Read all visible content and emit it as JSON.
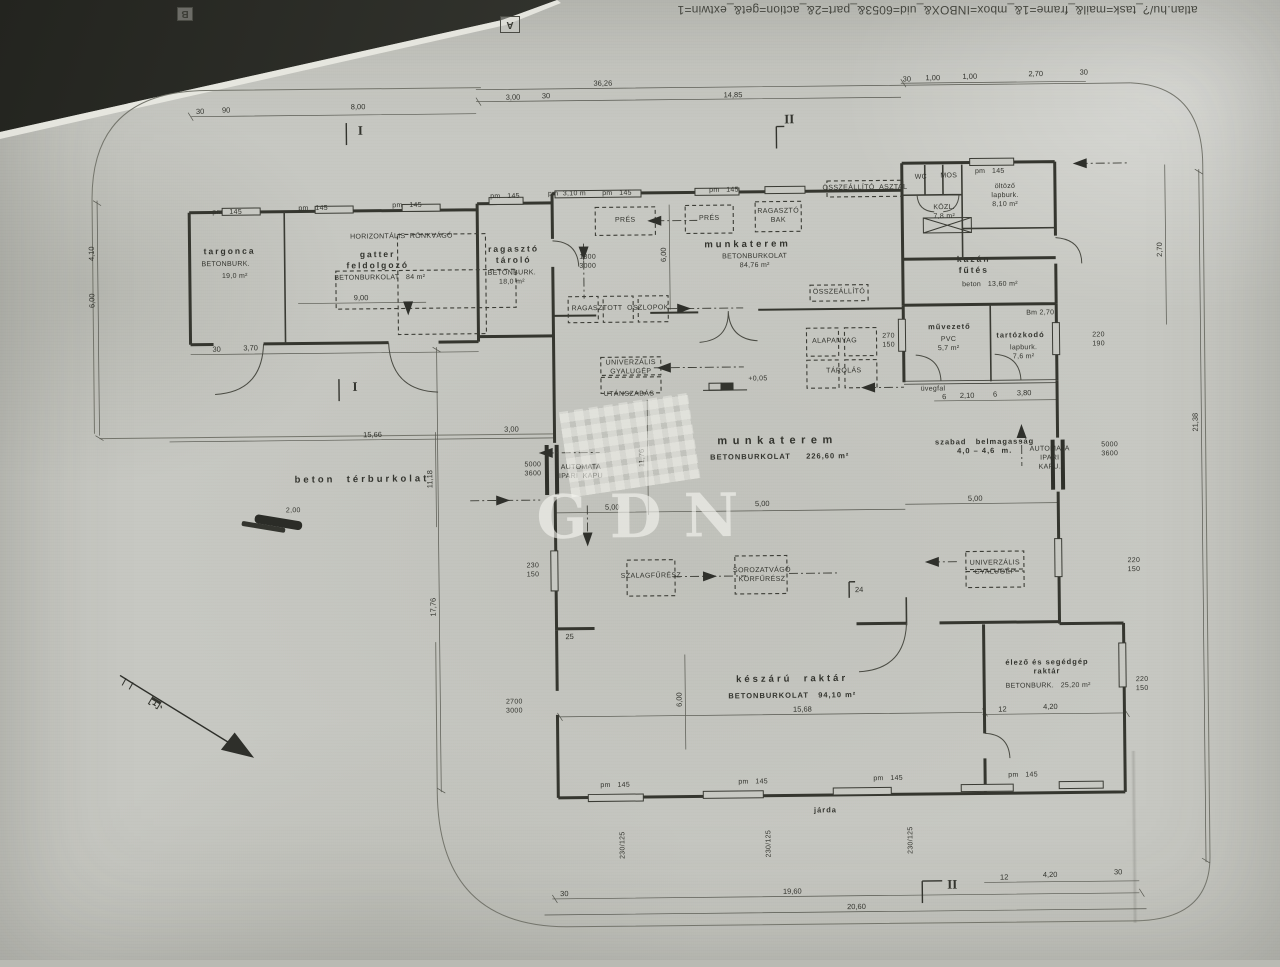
{
  "header": {
    "url": "atlan.hu/?_task=mail&_frame=1&_mbox=INBOX&_uid=6053&_part=2&_action=get&_extwin=1",
    "marker_a": "A",
    "marker_b": "B"
  },
  "watermark": {
    "text": "GDN"
  },
  "plan": {
    "labels": [
      {
        "n": "room-targonca",
        "t": "targonca",
        "x": 232,
        "y": 247,
        "c": "rm-s"
      },
      {
        "n": "finish-targonca",
        "t": "BETONBURK.",
        "x": 228,
        "y": 261,
        "c": "tny"
      },
      {
        "n": "area-targonca",
        "t": "19,0 m²",
        "x": 237,
        "y": 273,
        "c": "tny"
      },
      {
        "n": "room-gatter-feldolgozo",
        "t": "gatter\nfeldolgozó",
        "x": 380,
        "y": 257,
        "c": "rm-s"
      },
      {
        "n": "finish-gatter",
        "t": "BETONBURKOLAT   84 m²",
        "x": 382,
        "y": 276,
        "c": "tny"
      },
      {
        "n": "machine-horizontalis-ronkvago",
        "t": "HORIZONTÁLIS  RÖNKVÁGÓ",
        "x": 404,
        "y": 235,
        "c": "tny"
      },
      {
        "n": "room-ragaszto-tarolo",
        "t": "ragasztó\ntároló",
        "x": 516,
        "y": 253,
        "c": "rm-s"
      },
      {
        "n": "finish-ragaszto-tarolo",
        "t": "BETONBURK.\n18,0 m²",
        "x": 514,
        "y": 277,
        "c": "tny"
      },
      {
        "n": "room-munkaterem-1",
        "t": "munkaterem",
        "x": 750,
        "y": 246,
        "c": "rm"
      },
      {
        "n": "finish-munkaterem-1",
        "t": "BETONBURKOLAT\n84,76 m²",
        "x": 757,
        "y": 263,
        "c": "tny"
      },
      {
        "n": "machine-pres-1",
        "t": "PRÉS",
        "x": 628,
        "y": 221,
        "c": "mach"
      },
      {
        "n": "machine-pres-2",
        "t": "PRÉS",
        "x": 712,
        "y": 220,
        "c": "mach"
      },
      {
        "n": "machine-ragaszto-bak",
        "t": "RAGASZTÓ\nBAK",
        "x": 781,
        "y": 218,
        "c": "mach"
      },
      {
        "n": "machine-osszeallito-asztal",
        "t": "ÖSSZEÁLLÍTÓ  ASZTAL",
        "x": 868,
        "y": 191,
        "c": "mach"
      },
      {
        "n": "room-wc",
        "t": "WC",
        "x": 924,
        "y": 181,
        "c": "tny"
      },
      {
        "n": "room-mos",
        "t": "MOS",
        "x": 952,
        "y": 180,
        "c": "tny"
      },
      {
        "n": "room-oltozo",
        "t": "öltöző\nlapburk.\n8,10 m²",
        "x": 1008,
        "y": 200,
        "c": "tny"
      },
      {
        "n": "room-kozl",
        "t": "KÖZL.\n7,8 m²",
        "x": 947,
        "y": 216,
        "c": "tny"
      },
      {
        "n": "room-kazan-futes",
        "t": "kazán\nfűtés",
        "x": 976,
        "y": 268,
        "c": "rm-s"
      },
      {
        "n": "finish-kazan",
        "t": "beton   13,60 m²",
        "x": 992,
        "y": 289,
        "c": "tny"
      },
      {
        "n": "machine-osszeallito-2",
        "t": "ÖSSZEÁLLÍTÓ",
        "x": 841,
        "y": 295,
        "c": "mach"
      },
      {
        "n": "machine-alapanyag",
        "t": "ALAPANYAG",
        "x": 836,
        "y": 344,
        "c": "mach"
      },
      {
        "n": "machine-tarolas",
        "t": "TÁROLÁS",
        "x": 845,
        "y": 374,
        "c": "mach"
      },
      {
        "n": "machine-ragasztott-oszlopok",
        "t": "RAGASZTOTT  OSZLOPOK",
        "x": 622,
        "y": 309,
        "c": "mach"
      },
      {
        "n": "door-dim-1300-3000",
        "t": "1300\n3000",
        "x": 590,
        "y": 262,
        "c": "tny"
      },
      {
        "n": "room-muvezeto",
        "t": "művezető",
        "x": 951,
        "y": 330,
        "c": "sub"
      },
      {
        "n": "finish-muvezeto",
        "t": "PVC\n5,7 m²",
        "x": 950,
        "y": 348,
        "c": "tny"
      },
      {
        "n": "room-tartozkodo",
        "t": "tartózkodó",
        "x": 1022,
        "y": 339,
        "c": "sub"
      },
      {
        "n": "finish-tartozkodo",
        "t": "lapburk.\n7,6 m²",
        "x": 1025,
        "y": 357,
        "c": "tny"
      },
      {
        "n": "note-bm-270",
        "t": "Bm 2,70",
        "x": 1042,
        "y": 318,
        "c": "tny"
      },
      {
        "n": "note-uvegfal",
        "t": "üvegfal",
        "x": 934,
        "y": 393,
        "c": "tny"
      },
      {
        "n": "machine-univerzalis-gyalugep-1",
        "t": "UNIVERZÁLIS\nGYALUGÉP",
        "x": 632,
        "y": 368,
        "c": "mach"
      },
      {
        "n": "note-utanszabas",
        "t": "UTÁNSZABÁS",
        "x": 630,
        "y": 395,
        "c": "mach"
      },
      {
        "n": "note-level-mark",
        "t": "+0,05",
        "x": 759,
        "y": 381,
        "c": "tny"
      },
      {
        "n": "room-munkaterem-2",
        "t": "munkaterem",
        "x": 778,
        "y": 443,
        "c": "rml"
      },
      {
        "n": "finish-munkaterem-2",
        "t": "BETONBURKOLAT     226,60 m²",
        "x": 780,
        "y": 458,
        "c": "sub"
      },
      {
        "n": "note-szabad-belmagassag",
        "t": "szabad   belmagasság\n4,0 – 4,6  m.",
        "x": 985,
        "y": 450,
        "c": "sub"
      },
      {
        "n": "label-automata-kapu-right",
        "t": "AUTOMATA\nIPARI\nKAPU.",
        "x": 1050,
        "y": 463,
        "c": "tny"
      },
      {
        "n": "dim-kapu-right",
        "t": "5000\n3600",
        "x": 1110,
        "y": 455,
        "c": "tny"
      },
      {
        "n": "label-automata-kapu-left",
        "t": "AUTOMATA\nIPARI  KAPU",
        "x": 581,
        "y": 472,
        "c": "tny"
      },
      {
        "n": "dim-kapu-left",
        "t": "5000\n3600",
        "x": 533,
        "y": 469,
        "c": "tny"
      },
      {
        "n": "note-beton-terburkolat",
        "t": "beton  térburkolat",
        "x": 362,
        "y": 477,
        "c": "rm"
      },
      {
        "n": "machine-szalagfuresz",
        "t": "SZALAGFŰRÉSZ",
        "x": 650,
        "y": 577,
        "c": "mach"
      },
      {
        "n": "machine-sorozatvago-korfuresz",
        "t": "SOROZATVÁGÓ\nKÖRFŰRÉSZ",
        "x": 761,
        "y": 577,
        "c": "mach"
      },
      {
        "n": "machine-univerzalis-gyalugep-2",
        "t": "UNIVERZÁLIS\nGYALUGÉP",
        "x": 994,
        "y": 572,
        "c": "mach"
      },
      {
        "n": "room-keszaru-raktar",
        "t": "készárú  raktár",
        "x": 790,
        "y": 681,
        "c": "rm"
      },
      {
        "n": "finish-keszaru-raktar",
        "t": "BETONBURKOLAT   94,10 m²",
        "x": 790,
        "y": 697,
        "c": "sub"
      },
      {
        "n": "room-elezo-raktar",
        "t": "élező és segédgép\nraktár",
        "x": 1045,
        "y": 671,
        "c": "sub"
      },
      {
        "n": "finish-elezo-raktar",
        "t": "BETONBURK.   25,20 m²",
        "x": 1046,
        "y": 691,
        "c": "tny"
      },
      {
        "n": "note-jarda",
        "t": "járda",
        "x": 822,
        "y": 812,
        "c": "sub"
      },
      {
        "n": "north-letter",
        "t": "É",
        "x": 152,
        "y": 697,
        "c": "north",
        "r": 122
      },
      {
        "n": "door-dim-2700-3000",
        "t": "2700\n3000",
        "x": 512,
        "y": 706,
        "c": "tny"
      },
      {
        "n": "section-i-top",
        "t": "I",
        "x": 364,
        "y": 128,
        "c": "sec"
      },
      {
        "n": "section-i-mid",
        "t": "I",
        "x": 356,
        "y": 384,
        "c": "sec"
      },
      {
        "n": "section-ii-top",
        "t": "II",
        "x": 793,
        "y": 121,
        "c": "sec"
      },
      {
        "n": "section-ii-bottom",
        "t": "II",
        "x": 948,
        "y": 888,
        "c": "sec"
      },
      {
        "n": "dim-36-26",
        "t": "36,26",
        "x": 607,
        "y": 83,
        "c": "dim"
      },
      {
        "n": "dim-14-85",
        "t": "14,85",
        "x": 737,
        "y": 96,
        "c": "dim"
      },
      {
        "n": "dim-3-00-top",
        "t": "3,00",
        "x": 517,
        "y": 96,
        "c": "dim"
      },
      {
        "n": "tick-30-top1",
        "t": "30",
        "x": 550,
        "y": 95,
        "c": "dim"
      },
      {
        "n": "tick-30-left",
        "t": "30",
        "x": 204,
        "y": 107,
        "c": "dim"
      },
      {
        "n": "tick-90-left",
        "t": "90",
        "x": 230,
        "y": 106,
        "c": "dim"
      },
      {
        "n": "dim-8-00",
        "t": "8,00",
        "x": 362,
        "y": 104,
        "c": "dim"
      },
      {
        "n": "tick-30-r1",
        "t": "30",
        "x": 911,
        "y": 82,
        "c": "dim"
      },
      {
        "n": "dim-1-00-a",
        "t": "1,00",
        "x": 937,
        "y": 81,
        "c": "dim"
      },
      {
        "n": "dim-1-00-b",
        "t": "1,00",
        "x": 974,
        "y": 80,
        "c": "dim"
      },
      {
        "n": "dim-2-70-top",
        "t": "2,70",
        "x": 1040,
        "y": 78,
        "c": "dim"
      },
      {
        "n": "tick-30-r2",
        "t": "30",
        "x": 1088,
        "y": 77,
        "c": "dim"
      },
      {
        "n": "win-label-1",
        "t": "pm   145",
        "x": 230,
        "y": 209,
        "c": "tny"
      },
      {
        "n": "win-label-2",
        "t": "pm   145",
        "x": 316,
        "y": 206,
        "c": "tny"
      },
      {
        "n": "win-label-3",
        "t": "pm   145",
        "x": 410,
        "y": 204,
        "c": "tny"
      },
      {
        "n": "win-label-4",
        "t": "pm   145",
        "x": 508,
        "y": 196,
        "c": "tny"
      },
      {
        "n": "win-label-5",
        "t": "pm   145",
        "x": 620,
        "y": 194,
        "c": "tny"
      },
      {
        "n": "win-label-6",
        "t": "pm   145",
        "x": 727,
        "y": 192,
        "c": "tny"
      },
      {
        "n": "win-label-7",
        "t": "pm   145",
        "x": 993,
        "y": 176,
        "c": "tny"
      },
      {
        "n": "win-label-8",
        "t": "pm   145",
        "x": 612,
        "y": 786,
        "c": "tny"
      },
      {
        "n": "win-label-9",
        "t": "pm   145",
        "x": 750,
        "y": 784,
        "c": "tny"
      },
      {
        "n": "win-label-10",
        "t": "pm   145",
        "x": 885,
        "y": 782,
        "c": "tny"
      },
      {
        "n": "win-label-11",
        "t": "pm   145",
        "x": 1020,
        "y": 780,
        "c": "tny"
      },
      {
        "n": "win-label-pm-310",
        "t": "pm  3,10 m",
        "x": 570,
        "y": 194,
        "c": "tny"
      },
      {
        "n": "dim-6-00-v1",
        "t": "6,00",
        "x": 666,
        "y": 255,
        "c": "dim",
        "r": -90
      },
      {
        "n": "dim-6-00-v2",
        "t": "6,00",
        "x": 677,
        "y": 700,
        "c": "dim",
        "r": -90
      },
      {
        "n": "dim-4-10",
        "t": "4,10",
        "x": 94,
        "y": 248,
        "c": "dim",
        "r": -90
      },
      {
        "n": "dim-6-00-v3",
        "t": "6,00",
        "x": 94,
        "y": 295,
        "c": "dim",
        "r": -90
      },
      {
        "n": "dim-17-76",
        "t": "17,76",
        "x": 432,
        "y": 605,
        "c": "dim",
        "r": -90
      },
      {
        "n": "dim-11-18",
        "t": "11,18",
        "x": 430,
        "y": 477,
        "c": "dim",
        "r": -90
      },
      {
        "n": "dim-11-76",
        "t": "11,76",
        "x": 642,
        "y": 458,
        "c": "dim",
        "r": -90
      },
      {
        "n": "dim-2-70-right",
        "t": "2,70",
        "x": 1162,
        "y": 255,
        "c": "dim",
        "r": -90
      },
      {
        "n": "dim-21-38",
        "t": "21,38",
        "x": 1196,
        "y": 428,
        "c": "dim",
        "r": -90
      },
      {
        "n": "dim-5-00-a",
        "t": "5,00",
        "x": 612,
        "y": 507,
        "c": "dim"
      },
      {
        "n": "dim-5-00-b",
        "t": "5,00",
        "x": 762,
        "y": 505,
        "c": "dim"
      },
      {
        "n": "dim-5-00-c",
        "t": "5,00",
        "x": 975,
        "y": 502,
        "c": "dim"
      },
      {
        "n": "dim-15-66",
        "t": "15,66",
        "x": 373,
        "y": 432,
        "c": "dim"
      },
      {
        "n": "dim-3-00-mid",
        "t": "3,00",
        "x": 512,
        "y": 428,
        "c": "dim"
      },
      {
        "n": "dim-9-00",
        "t": "9,00",
        "x": 363,
        "y": 295,
        "c": "dim"
      },
      {
        "n": "tick-30-blocka",
        "t": "30",
        "x": 218,
        "y": 345,
        "c": "dim"
      },
      {
        "n": "dim-3-70",
        "t": "3,70",
        "x": 252,
        "y": 344,
        "c": "dim"
      },
      {
        "n": "win-dim-230-150",
        "t": "230\n150",
        "x": 532,
        "y": 570,
        "c": "tny"
      },
      {
        "n": "win-dim-220-150-a",
        "t": "220\n150",
        "x": 1133,
        "y": 571,
        "c": "tny"
      },
      {
        "n": "win-dim-270-150",
        "t": "270\n150",
        "x": 890,
        "y": 344,
        "c": "tny"
      },
      {
        "n": "win-dim-220-190",
        "t": "220\n190",
        "x": 1100,
        "y": 345,
        "c": "tny"
      },
      {
        "n": "win-dim-220-150-b",
        "t": "220\n150",
        "x": 1140,
        "y": 690,
        "c": "tny"
      },
      {
        "n": "dim-2-10",
        "t": "2,10",
        "x": 968,
        "y": 399,
        "c": "dim"
      },
      {
        "n": "tick-6-a",
        "t": "6",
        "x": 945,
        "y": 400,
        "c": "dim"
      },
      {
        "n": "tick-6-b",
        "t": "6",
        "x": 996,
        "y": 398,
        "c": "dim"
      },
      {
        "n": "dim-3-80",
        "t": "3,80",
        "x": 1025,
        "y": 397,
        "c": "dim"
      },
      {
        "n": "dim-15-68",
        "t": "15,68",
        "x": 800,
        "y": 711,
        "c": "dim"
      },
      {
        "n": "tick-12-a",
        "t": "12",
        "x": 1000,
        "y": 713,
        "c": "dim"
      },
      {
        "n": "dim-4-20-a",
        "t": "4,20",
        "x": 1048,
        "y": 711,
        "c": "dim"
      },
      {
        "n": "dim-19-60",
        "t": "19,60",
        "x": 788,
        "y": 893,
        "c": "dim"
      },
      {
        "n": "dim-20-60",
        "t": "20,60",
        "x": 852,
        "y": 909,
        "c": "dim"
      },
      {
        "n": "tick-30-bottom",
        "t": "30",
        "x": 560,
        "y": 893,
        "c": "dim"
      },
      {
        "n": "tick-12-b",
        "t": "12",
        "x": 1000,
        "y": 881,
        "c": "dim"
      },
      {
        "n": "dim-4-20-b",
        "t": "4,20",
        "x": 1046,
        "y": 879,
        "c": "dim"
      },
      {
        "n": "tick-30-br",
        "t": "30",
        "x": 1114,
        "y": 877,
        "c": "dim"
      },
      {
        "n": "win-dim-230-125-a",
        "t": "230/125",
        "x": 620,
        "y": 845,
        "c": "tny",
        "r": -90
      },
      {
        "n": "win-dim-230-125-b",
        "t": "230/125",
        "x": 766,
        "y": 845,
        "c": "tny",
        "r": -90
      },
      {
        "n": "win-dim-230-125-c",
        "t": "230/125",
        "x": 908,
        "y": 843,
        "c": "tny",
        "r": -90
      },
      {
        "n": "tick-25",
        "t": "25",
        "x": 568,
        "y": 636,
        "c": "dim"
      },
      {
        "n": "tick-24",
        "t": "24",
        "x": 858,
        "y": 592,
        "c": "dim"
      },
      {
        "n": "dim-2-00",
        "t": "2,00",
        "x": 293,
        "y": 508,
        "c": "tny"
      }
    ]
  }
}
